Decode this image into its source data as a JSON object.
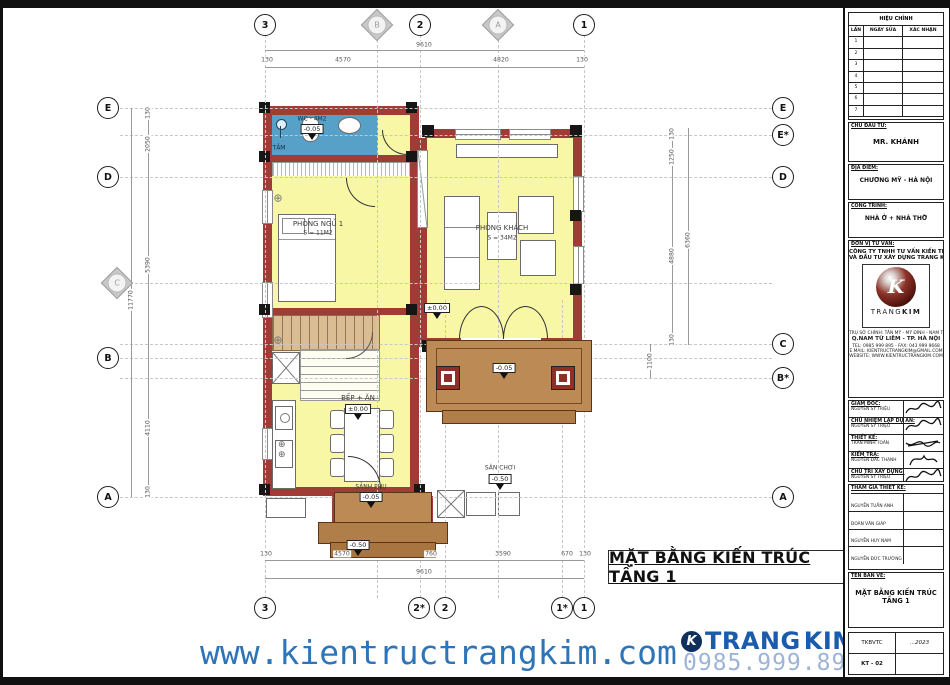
{
  "drawing_title": "MẶT BẰNG KIẾN TRÚC TẦNG 1",
  "grid": {
    "top": [
      "3",
      "B",
      "2",
      "A",
      "1"
    ],
    "bottom": [
      "3",
      "2*",
      "2",
      "1*",
      "1"
    ],
    "left": [
      "E",
      "D",
      "C",
      "B",
      "A"
    ],
    "right": [
      "E",
      "E*",
      "D",
      "C",
      "B*",
      "A"
    ]
  },
  "dims": {
    "top_total": "9610",
    "top": [
      "130",
      "4570",
      "4820",
      "130"
    ],
    "left_total": "11770",
    "left": [
      "130",
      "2050",
      "5390",
      "4110",
      "130"
    ],
    "right_total": "6360",
    "right": [
      "130",
      "1250",
      "4880",
      "130"
    ],
    "right_offset": "1100",
    "bottom": [
      "130",
      "4570",
      "760",
      "3590",
      "670",
      "130"
    ],
    "bottom_total": "9610"
  },
  "rooms": {
    "wc": {
      "label": "WC - 4M2",
      "elev": "-0.05"
    },
    "bath": {
      "label": "TẮM"
    },
    "bedroom": {
      "name": "PHÒNG NGỦ 1",
      "area": "S = 11M2"
    },
    "living": {
      "name": "PHÒNG KHÁCH",
      "area": "S = 34M2"
    },
    "kitchen": {
      "name": "BẾP + ĂN",
      "elev": "±0.00"
    },
    "main_porch": {
      "name": "SẢNH CHÍNH",
      "elev": "-0.05"
    },
    "side_porch": {
      "name": "SẢNH PHỤ",
      "elev": "-0.05"
    },
    "playground": {
      "name": "SÂN CHƠI",
      "elev": "-0.50"
    },
    "entrance": {
      "elev": "±0.00"
    },
    "step": {
      "elev": "-0.50"
    }
  },
  "titleblock": {
    "revision": {
      "title": "HIỆU CHỈNH",
      "cols": [
        "LẦN",
        "NGÀY SỬA",
        "XÁC NHẬN"
      ],
      "rows": [
        "1",
        "2",
        "3",
        "4",
        "5",
        "6",
        "7"
      ]
    },
    "investor": {
      "label": "CHỦ ĐẦU TƯ:",
      "value": "MR. KHÁNH"
    },
    "location": {
      "label": "ĐỊA ĐIỂM:",
      "value": "CHƯƠNG MỸ - HÀ NỘI"
    },
    "project": {
      "label": "CÔNG TRÌNH:",
      "value": "NHÀ Ở + NHÀ THỜ"
    },
    "consultant": {
      "label": "ĐƠN VỊ TƯ VẤN:",
      "name1": "CÔNG TY TNHH TƯ VẤN KIẾN TRÚC",
      "name2": "VÀ ĐẦU TƯ XÂY DỰNG TRANG KIM",
      "logo_k": "K",
      "logo_word1": "TRANG",
      "logo_word2": "KIM",
      "address1": "TRỤ SỞ CHÍNH: TÂN MỸ - MỸ ĐÌNH - NAM TỪ LIÊM - HÀ NỘI",
      "address2": "Q.NAM TỪ LIÊM - TP. HÀ NỘI",
      "tel": "TEL: 0985 999 895 - FAX: 043 999 9668",
      "email": "E.MAIL: KIENTRUCTRANGKIM@GMAIL.COM",
      "website": "WEBSITE: WWW.KIENTRUCTRANGKIM.COM"
    },
    "signatories": [
      {
        "label": "GIÁM ĐỐC:",
        "name": "NGUYỄN SỸ TRIỆU"
      },
      {
        "label": "CHỦ NHIỆM LẬP DỰ ÁN:",
        "name": "NGUYỄN SỸ TRIỆU"
      },
      {
        "label": "THIẾT KẾ:",
        "name": "TRẦN MINH TOÀN"
      },
      {
        "label": "KIỂM TRA:",
        "name": "NGUYỄN ĐẮC THẠNH"
      },
      {
        "label": "CHỦ TRÌ XÂY DỰNG:",
        "name": "NGUYỄN SỸ TRIỆU"
      }
    ],
    "participants": {
      "label": "THAM GIA THIẾT KẾ:",
      "names": [
        "NGUYỄN TUẤN ANH",
        "ĐOÀN VĂN GIÁP",
        "NGUYỄN HUY NAM",
        "NGUYỄN ĐỨC TRƯỜNG"
      ]
    },
    "drawing": {
      "label": "TÊN BẢN VẼ:",
      "value": "MẶT BẰNG KIẾN TRÚC TẦNG 1"
    },
    "meta": {
      "stage": "TKBVTC",
      "year": "...2023",
      "code": "KT - 02"
    }
  },
  "footer": {
    "website": "www.kientructrangkim.com",
    "phone": "0985.999.895",
    "brand_icon": "K",
    "brand1": "TRANG",
    "brand2": "KIM"
  },
  "colors": {
    "wall": "#9e3c35",
    "floor_yellow": "#f8f7a6",
    "wc_blue": "#57a0c8",
    "porch_brown": "#bc8a55",
    "footer_blue": "#2e74b8"
  }
}
